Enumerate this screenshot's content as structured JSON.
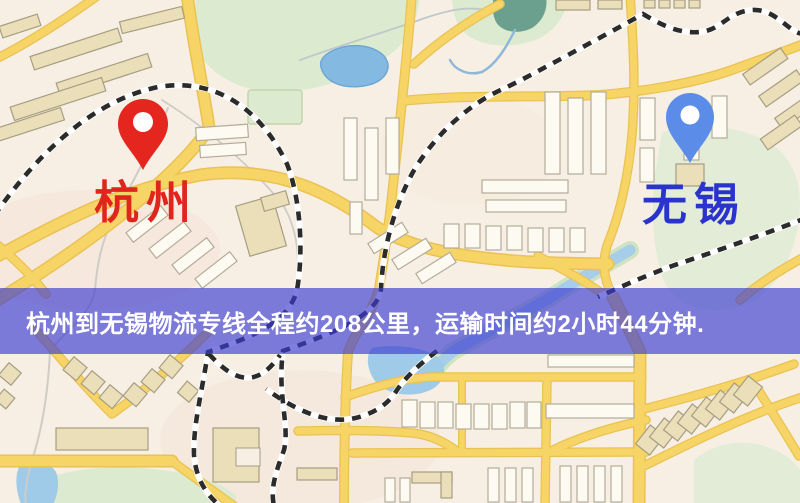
{
  "banner": {
    "text": "杭州到无锡物流专线全程约208公里，运输时间约2小时44分钟.",
    "background_color": "rgba(60,60,210,0.66)",
    "text_color": "#ffffff"
  },
  "route": {
    "origin": "杭州",
    "destination": "无锡",
    "distance_text": "约208公里",
    "duration_text": "约2小时44分钟"
  },
  "map": {
    "origin_marker": {
      "label": "杭州",
      "pin_color": "#e5261e",
      "label_color": "#e0251c",
      "icon": "map-pin"
    },
    "destination_marker": {
      "label": "无锡",
      "pin_color": "#5b8ce8",
      "label_color": "#2a34cd",
      "icon": "map-pin"
    },
    "palette": {
      "background": "#f7efe3",
      "road_fill": "#f7d466",
      "road_casing": "#eac253",
      "park_green": "#dcead0",
      "water_blue": "#8fc0e4",
      "teal_pond": "#6ca08e",
      "railway_dark": "#2b2b2b",
      "building_white": "#fdfaf1",
      "building_tan": "#eadfb9"
    }
  }
}
